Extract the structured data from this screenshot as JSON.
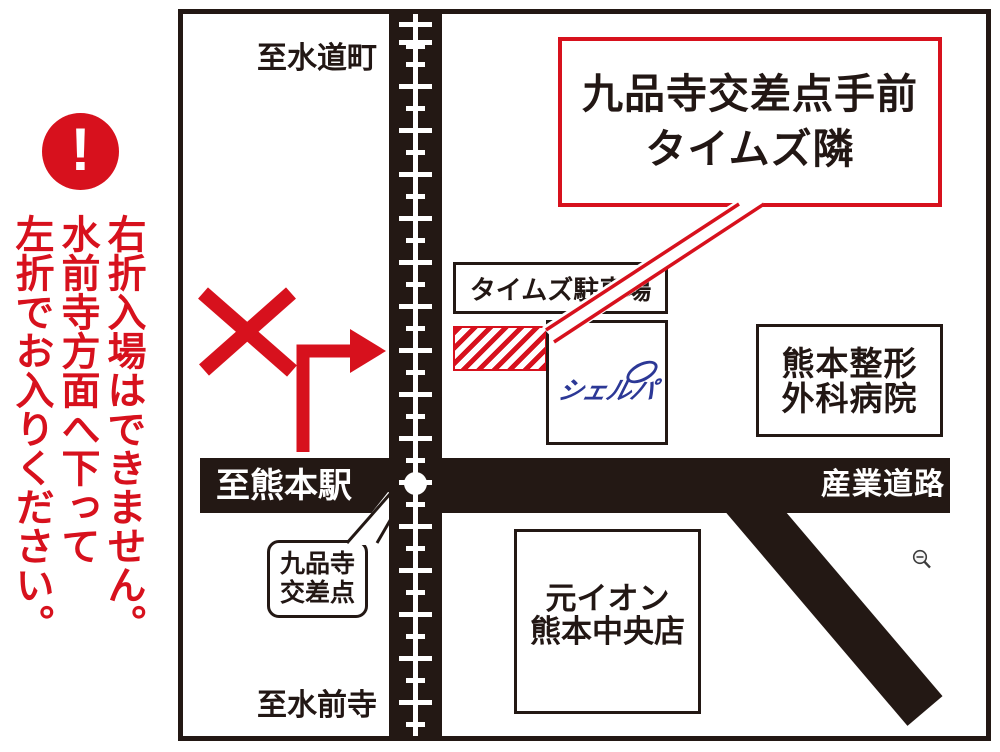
{
  "map": {
    "area_labels": {
      "top": "至水道町",
      "bottom": "至水前寺"
    },
    "roads": {
      "left_label": "至熊本駅",
      "right_label": "産業道路"
    },
    "callout": {
      "text": "九品寺交差点手前\nタイムズ隣"
    },
    "buildings": {
      "times_parking": "タイムズ駐車場",
      "sherpa": "シェルパ",
      "hospital": "熊本整形\n外科病院",
      "former_aeon": "元イオン\n熊本中央店"
    },
    "intersection_label": "九品寺\n交差点"
  },
  "warning": {
    "mark": "!",
    "text": "右折入場はできません。\n水前寺方面へ下って\n左折でお入りください。"
  },
  "colors": {
    "accent_red": "#d7111d",
    "map_black": "#231814",
    "sherpa_blue": "#2c3896"
  }
}
